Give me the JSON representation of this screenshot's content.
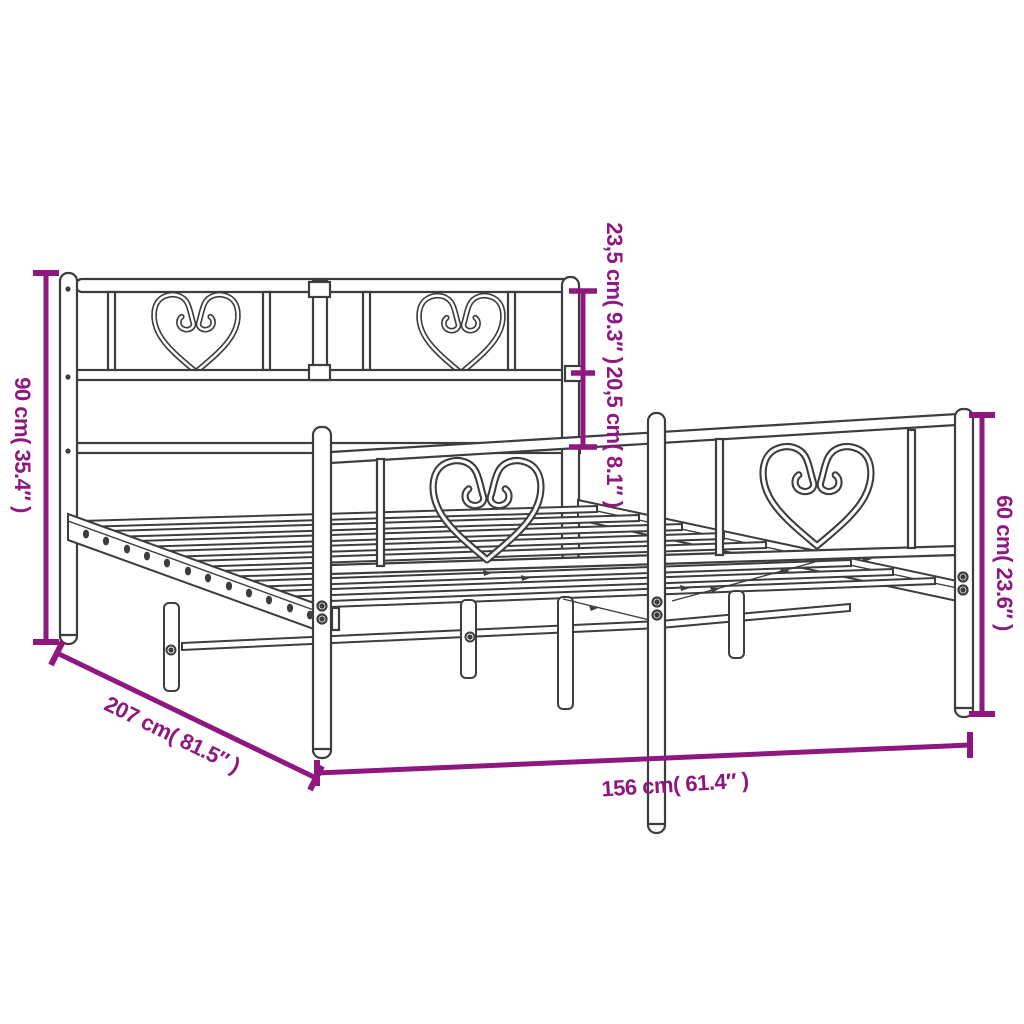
{
  "page": {
    "background": "#ffffff"
  },
  "diagram": {
    "stroke_color": "#3d3d3d",
    "dimension_color": "#8e1880",
    "labels": [
      {
        "id": "headboard-height",
        "text": "90 cm( 35.4″ )"
      },
      {
        "id": "frame-length",
        "text": "207 cm( 81.5″ )"
      },
      {
        "id": "frame-width",
        "text": "156 cm( 61.4″ )"
      },
      {
        "id": "footboard-height",
        "text": "60 cm( 23.6″ )"
      },
      {
        "id": "headboard-upper-section",
        "text": "23,5 cm( 9.3″ )"
      },
      {
        "id": "headboard-mid-section",
        "text": "20,5 cm( 8.1″ )"
      }
    ]
  }
}
